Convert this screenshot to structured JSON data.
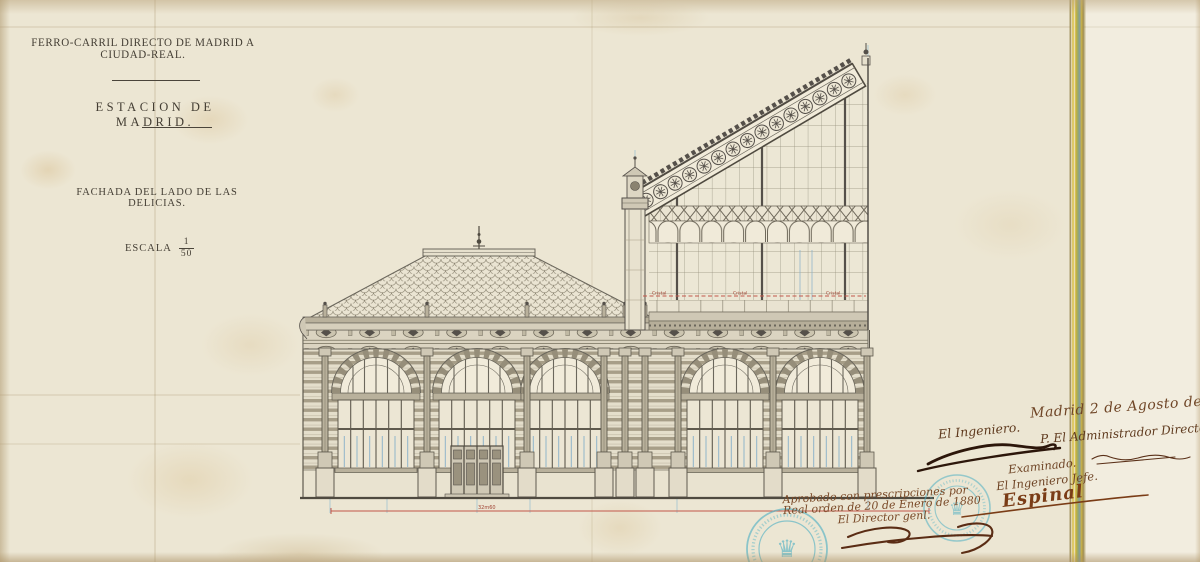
{
  "title_block": {
    "railway": "FERRO-CARRIL DIRECTO DE MADRID A CIUDAD-REAL.",
    "station": "ESTACION DE MADRID.",
    "subtitle": "FACHADA DEL LADO DE LAS DELICIAS.",
    "scale": {
      "label": "ESCALA",
      "numerator": "1",
      "denominator": "50"
    }
  },
  "drawing": {
    "glass_line_labels": [
      "Cristal",
      "Cristal",
      "Cristal"
    ],
    "width_dimension": "32m60"
  },
  "signatures": {
    "date": "Madrid 2 de Agosto de 1879.",
    "engineer": "El Ingeniero.",
    "administrator": "P. El Administrador Director.",
    "examined": "Examinado.",
    "chief_engineer": "El Ingeniero Jefe.",
    "chief_signature": "Espinal"
  },
  "approval": {
    "line1": "Aprobado con prescripciones por",
    "line2": "Real orden de 20 de Enero de 1880",
    "line3": "El Director genl."
  },
  "colors": {
    "paper": "#ece6d3",
    "ink": "#47423a",
    "red_line": "#c2574a",
    "blue_guide": "#9cc2d2",
    "handwriting_brown": "#6f4526",
    "signature_dark": "#2c160a",
    "stamp_teal": "#4fb0c4",
    "binding_yellow": "#d6b92f",
    "binding_green": "#8ea66b"
  }
}
